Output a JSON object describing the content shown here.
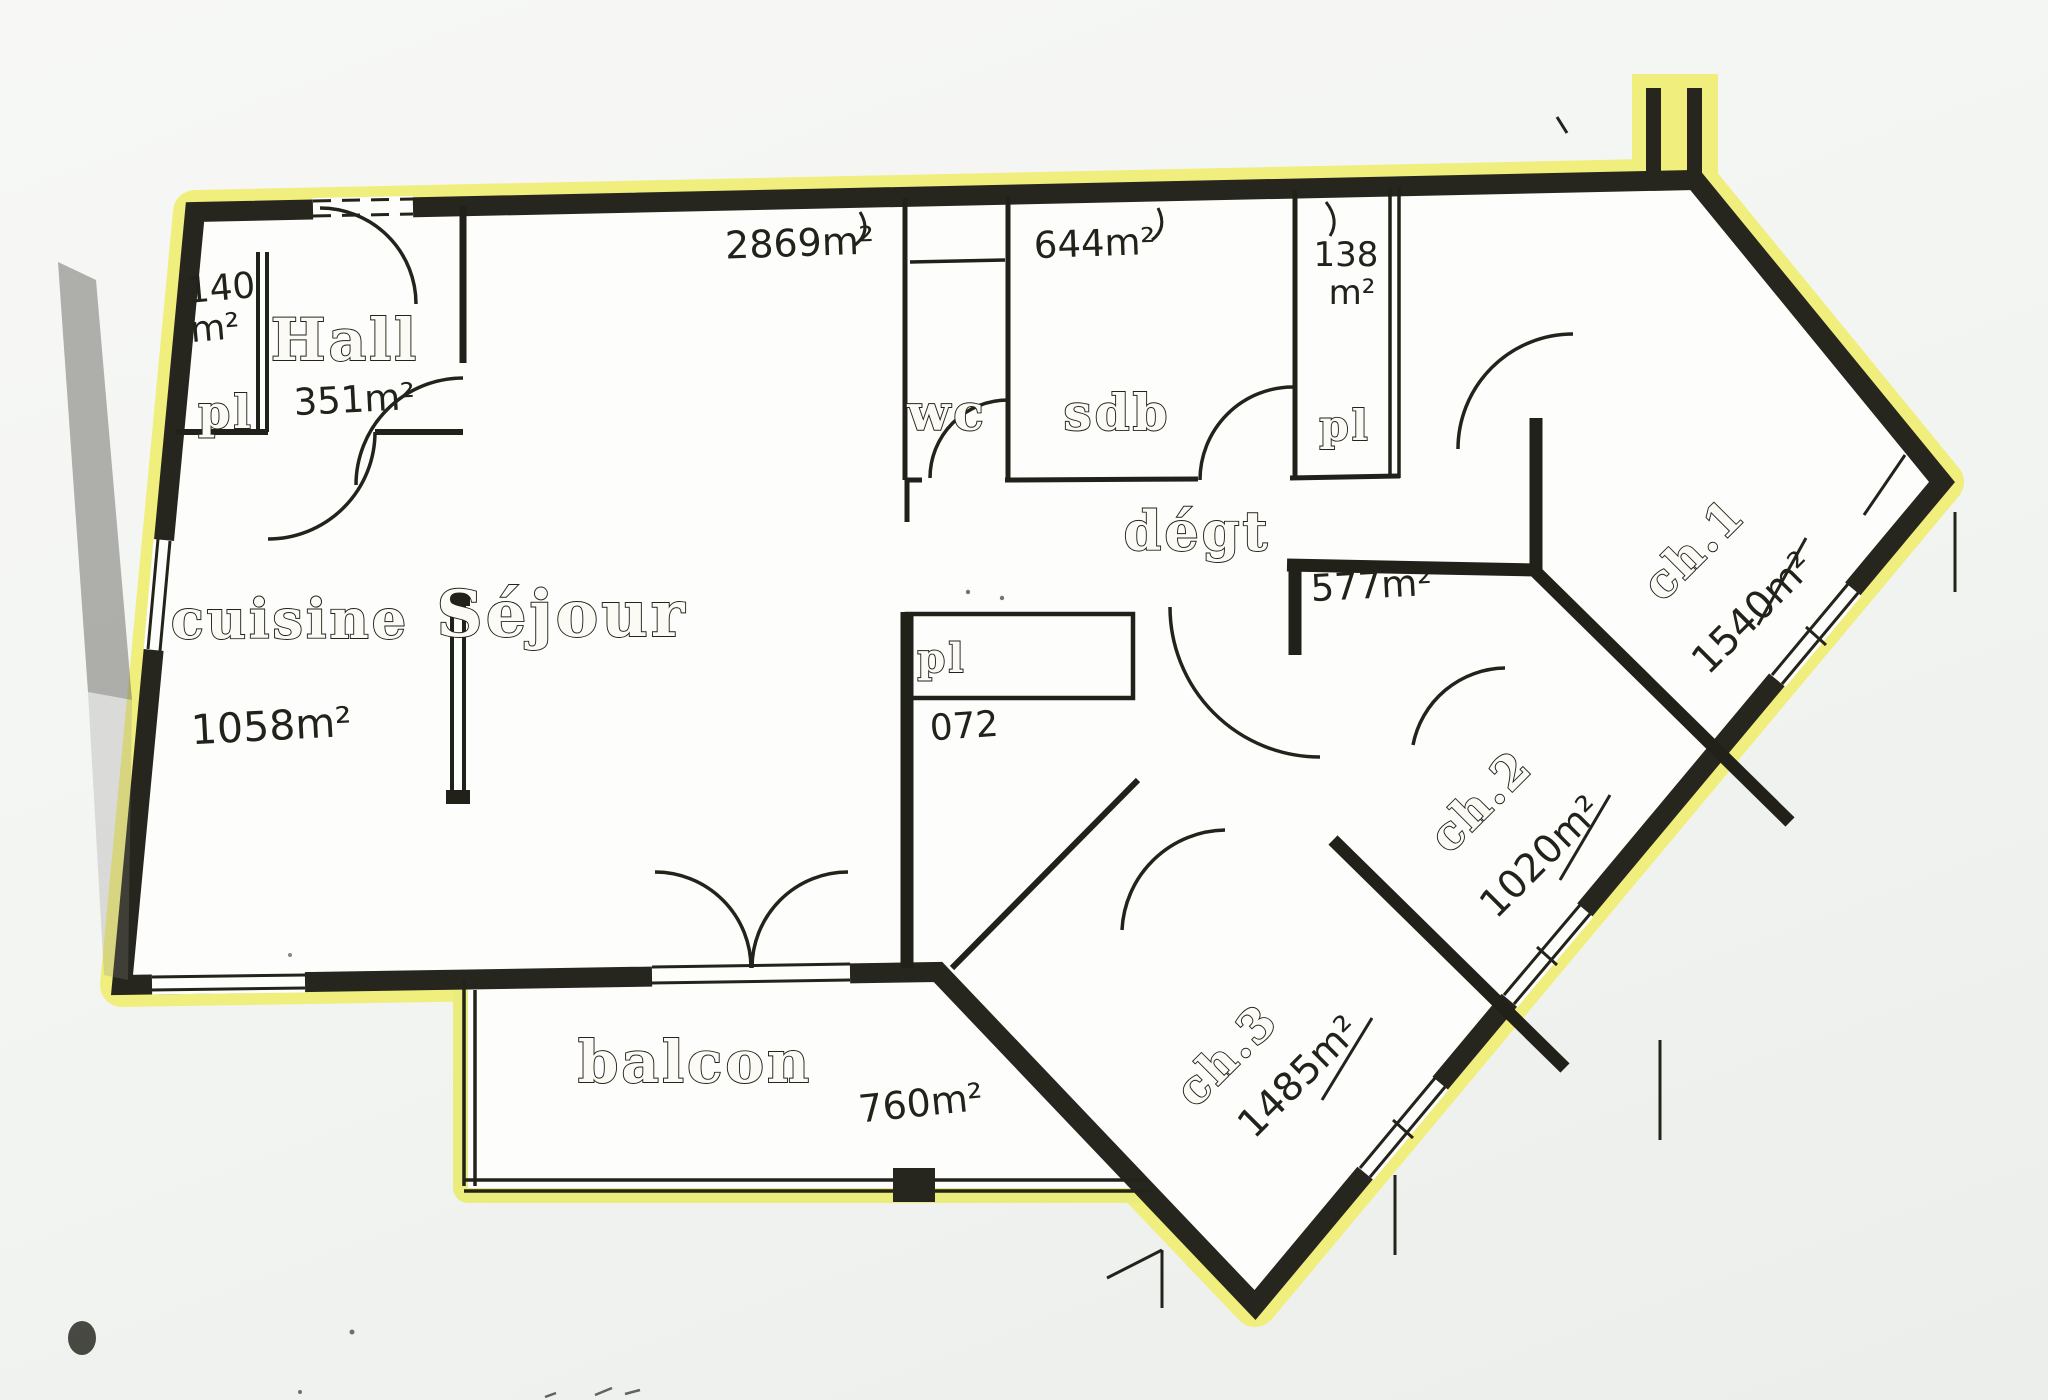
{
  "document": {
    "kind": "hand-drawn apartment floor plan, photographed, outline traced with yellow highlighter"
  },
  "colors": {
    "highlight": "#f0ee7d",
    "wall": "#26261e",
    "paper": "#fdfdfb",
    "ink": "#22221b",
    "background": "#f3f5f3"
  },
  "rooms": {
    "hall": {
      "name": "Hall",
      "area": "351m²"
    },
    "entry_closet": {
      "name": "pl",
      "area_value": "140",
      "area_unit": "m²"
    },
    "cuisine": {
      "name": "cuisine",
      "area": "1058m²"
    },
    "sejour": {
      "name": "Séjour",
      "area": "2869m²"
    },
    "wc": {
      "name": "wc"
    },
    "sdb": {
      "name": "sdb",
      "area": "644m²"
    },
    "closet_top_right": {
      "name": "pl",
      "area_value": "138",
      "area_unit": "m²"
    },
    "degagement": {
      "name": "dégt",
      "area": "577m²"
    },
    "closet_middle": {
      "name": "pl",
      "area": "072"
    },
    "ch1": {
      "name": "ch.1",
      "area": "1540m²"
    },
    "ch2": {
      "name": "ch.2",
      "area": "1020m²"
    },
    "ch3": {
      "name": "ch.3",
      "area": "1485m²"
    },
    "balcon": {
      "name": "balcon",
      "area": "760m²"
    }
  }
}
